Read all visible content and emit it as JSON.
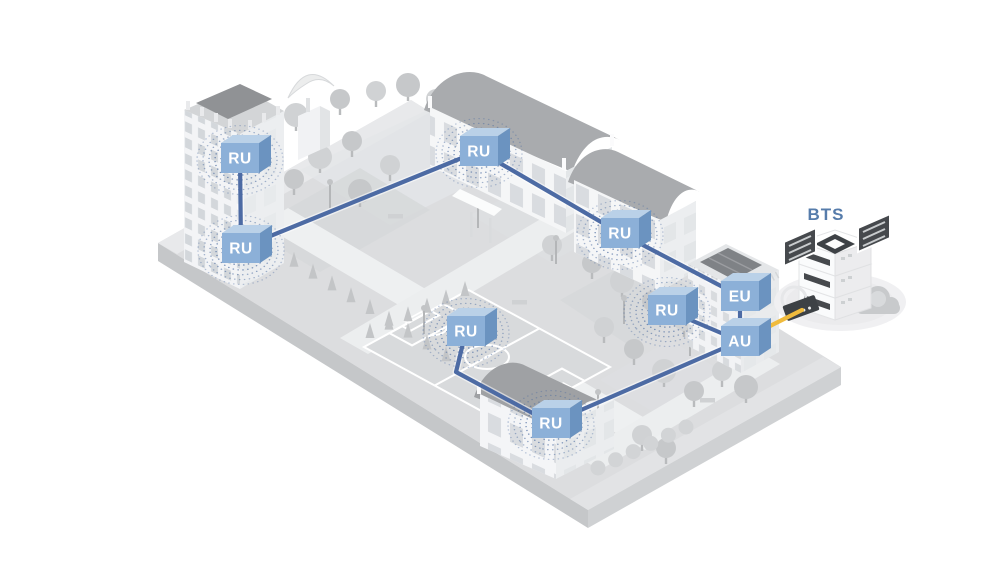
{
  "diagram": {
    "type": "isometric-das-network-illustration",
    "bts_label": "BTS",
    "nodes": [
      {
        "id": "ru-tower-upper",
        "label": "RU",
        "x": 240,
        "y": 158,
        "waves": true
      },
      {
        "id": "ru-tower-lower",
        "label": "RU",
        "x": 241,
        "y": 248,
        "waves": true
      },
      {
        "id": "ru-school-north",
        "label": "RU",
        "x": 479,
        "y": 151,
        "waves": true
      },
      {
        "id": "ru-annex-east",
        "label": "RU",
        "x": 620,
        "y": 233,
        "waves": true
      },
      {
        "id": "ru-plaza",
        "label": "RU",
        "x": 667,
        "y": 310,
        "waves": true
      },
      {
        "id": "ru-field",
        "label": "RU",
        "x": 466,
        "y": 331,
        "waves": true
      },
      {
        "id": "ru-school-south",
        "label": "RU",
        "x": 551,
        "y": 423,
        "waves": true
      },
      {
        "id": "eu",
        "label": "EU",
        "x": 740,
        "y": 296,
        "waves": false
      },
      {
        "id": "au",
        "label": "AU",
        "x": 740,
        "y": 341,
        "waves": false
      }
    ],
    "links": [
      {
        "from": "ru-tower-upper",
        "to": "ru-tower-lower",
        "kind": "fiber"
      },
      {
        "from": "ru-tower-lower",
        "to": "ru-school-north",
        "kind": "fiber"
      },
      {
        "from": "ru-school-north",
        "to": "ru-annex-east",
        "kind": "fiber"
      },
      {
        "from": "ru-annex-east",
        "to": "eu",
        "kind": "fiber"
      },
      {
        "from": "eu",
        "to": "au",
        "kind": "fiber"
      },
      {
        "from": "ru-plaza",
        "to": "au",
        "kind": "fiber"
      },
      {
        "from": "au",
        "to": "ru-school-south",
        "kind": "fiber"
      },
      {
        "from": "ru-field",
        "to": "ru-school-south",
        "kind": "fiber",
        "via": [
          [
            456,
            372
          ]
        ]
      },
      {
        "from": "au",
        "to": [
          802,
          310
        ],
        "kind": "power"
      }
    ],
    "colors": {
      "cube_front": "#8cb0d8",
      "cube_top": "#bad1e8",
      "cube_side": "#6b93c0",
      "cube_text": "#ffffff",
      "fiber": "#4d6ba4",
      "power": "#f0bb3d",
      "wave": "#4a6b9f",
      "bts_text": "#567cab"
    }
  }
}
